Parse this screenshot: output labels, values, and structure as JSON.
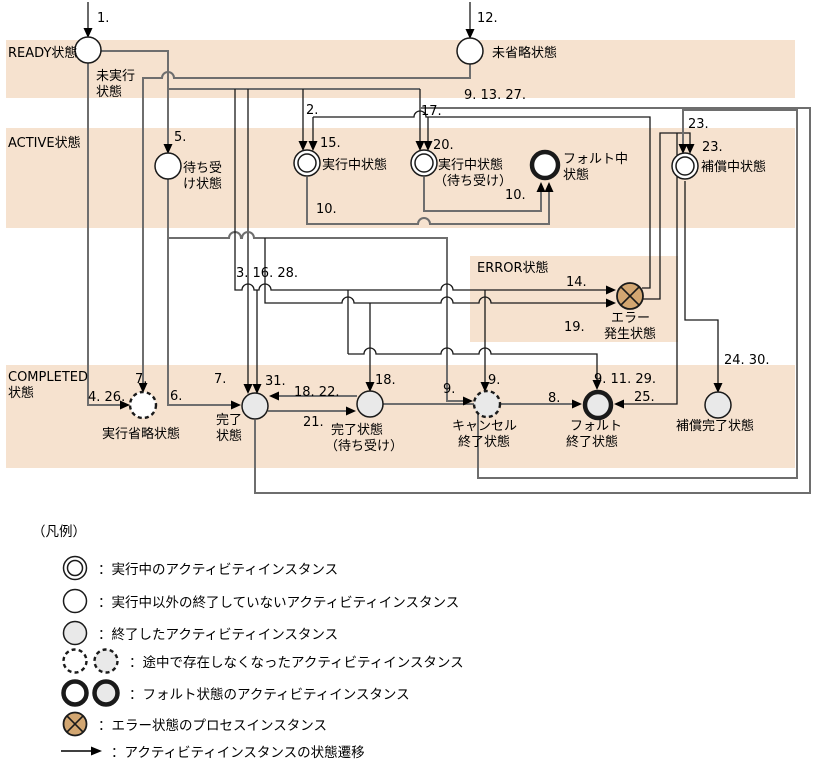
{
  "meta": {
    "width": 814,
    "height": 765
  },
  "colors": {
    "band": "#f6e2cf",
    "line_gray": "#6e6e6e",
    "line_black": "#1a1a1a",
    "node_stroke": "#1a1a1a",
    "gray_fill": "#e9e9e9",
    "white_fill": "#ffffff",
    "error_fill": "#d2a671",
    "arrow": "#000000",
    "text": "#000000"
  },
  "bands": [
    {
      "name": "band-ready",
      "x": 6,
      "y": 40,
      "w": 789,
      "h": 58
    },
    {
      "name": "band-active",
      "x": 6,
      "y": 128,
      "w": 789,
      "h": 100
    },
    {
      "name": "band-error",
      "x": 470,
      "y": 256,
      "w": 208,
      "h": 86
    },
    {
      "name": "band-completed",
      "x": 6,
      "y": 365,
      "w": 789,
      "h": 103
    }
  ],
  "nodes": [
    {
      "id": "state-unexecuted",
      "type": "white",
      "cx": 88,
      "cy": 50
    },
    {
      "id": "state-unskipped",
      "type": "white",
      "cx": 470,
      "cy": 51
    },
    {
      "id": "state-waiting",
      "type": "white",
      "cx": 168,
      "cy": 166
    },
    {
      "id": "state-executing",
      "type": "double",
      "cx": 307,
      "cy": 163
    },
    {
      "id": "state-executing-waiting",
      "type": "double",
      "cx": 424,
      "cy": 163
    },
    {
      "id": "state-faulting",
      "type": "fault-white",
      "cx": 545,
      "cy": 165
    },
    {
      "id": "state-compensating",
      "type": "double",
      "cx": 685,
      "cy": 166
    },
    {
      "id": "state-error-occurred",
      "type": "error",
      "cx": 630,
      "cy": 296
    },
    {
      "id": "state-execution-skipped",
      "type": "dashed-white",
      "cx": 143,
      "cy": 405
    },
    {
      "id": "state-completed",
      "type": "gray",
      "cx": 255,
      "cy": 406
    },
    {
      "id": "state-completed-waiting",
      "type": "gray",
      "cx": 370,
      "cy": 404
    },
    {
      "id": "state-cancel-ended",
      "type": "dashed-gray",
      "cx": 487,
      "cy": 404
    },
    {
      "id": "state-fault-ended",
      "type": "fault-gray",
      "cx": 598,
      "cy": 405
    },
    {
      "id": "state-compensation-completed",
      "type": "gray",
      "cx": 718,
      "cy": 405
    }
  ],
  "texts": [
    {
      "t": "READY状態",
      "x": 8,
      "y": 57,
      "cls": "band"
    },
    {
      "t": "ACTIVE状態",
      "x": 8,
      "y": 147,
      "cls": "band"
    },
    {
      "t": "ERROR状態",
      "x": 477,
      "y": 272,
      "cls": "band"
    },
    {
      "t": "COMPLETED",
      "x": 8,
      "y": 381,
      "cls": "band"
    },
    {
      "t": "状態",
      "x": 8,
      "y": 397,
      "cls": "band"
    },
    {
      "t": "未実行",
      "x": 96,
      "y": 80,
      "cls": "lbl"
    },
    {
      "t": "状態",
      "x": 96,
      "y": 96,
      "cls": "lbl"
    },
    {
      "t": "未省略状態",
      "x": 492,
      "y": 57,
      "cls": "lbl"
    },
    {
      "t": "待ち受",
      "x": 183,
      "y": 172,
      "cls": "lbl"
    },
    {
      "t": "け状態",
      "x": 183,
      "y": 188,
      "cls": "lbl"
    },
    {
      "t": "実行中状態",
      "x": 322,
      "y": 169,
      "cls": "lbl"
    },
    {
      "t": "実行中状態",
      "x": 438,
      "y": 169,
      "cls": "lbl"
    },
    {
      "t": "（待ち受け）",
      "x": 434,
      "y": 185,
      "cls": "lbl"
    },
    {
      "t": "フォルト中",
      "x": 563,
      "y": 163,
      "cls": "lbl"
    },
    {
      "t": "状態",
      "x": 563,
      "y": 179,
      "cls": "lbl"
    },
    {
      "t": "補償中状態",
      "x": 701,
      "y": 171,
      "cls": "lbl"
    },
    {
      "t": "エラー",
      "x": 611,
      "y": 322,
      "cls": "lbl"
    },
    {
      "t": "発生状態",
      "x": 604,
      "y": 338,
      "cls": "lbl"
    },
    {
      "t": "実行省略状態",
      "x": 102,
      "y": 438,
      "cls": "lbl"
    },
    {
      "t": "完了",
      "x": 216,
      "y": 424,
      "cls": "lbl"
    },
    {
      "t": "状態",
      "x": 216,
      "y": 440,
      "cls": "lbl"
    },
    {
      "t": "完了状態",
      "x": 331,
      "y": 434,
      "cls": "lbl"
    },
    {
      "t": "（待ち受け）",
      "x": 325,
      "y": 450,
      "cls": "lbl"
    },
    {
      "t": "キャンセル",
      "x": 452,
      "y": 430,
      "cls": "lbl"
    },
    {
      "t": "終了状態",
      "x": 458,
      "y": 446,
      "cls": "lbl"
    },
    {
      "t": "フォルト",
      "x": 570,
      "y": 430,
      "cls": "lbl"
    },
    {
      "t": "終了状態",
      "x": 566,
      "y": 446,
      "cls": "lbl"
    },
    {
      "t": "補償完了状態",
      "x": 676,
      "y": 430,
      "cls": "lbl"
    },
    {
      "t": "1.",
      "x": 97,
      "y": 22,
      "cls": "num"
    },
    {
      "t": "12.",
      "x": 477,
      "y": 22,
      "cls": "num"
    },
    {
      "t": "9. 13. 27.",
      "x": 464,
      "y": 99,
      "cls": "num"
    },
    {
      "t": "17.",
      "x": 421,
      "y": 115,
      "cls": "num"
    },
    {
      "t": "2.",
      "x": 306,
      "y": 114,
      "cls": "num"
    },
    {
      "t": "5.",
      "x": 174,
      "y": 141,
      "cls": "num"
    },
    {
      "t": "15.",
      "x": 320,
      "y": 147,
      "cls": "num"
    },
    {
      "t": "20.",
      "x": 433,
      "y": 149,
      "cls": "num"
    },
    {
      "t": "23.",
      "x": 688,
      "y": 128,
      "cls": "num"
    },
    {
      "t": "23.",
      "x": 702,
      "y": 151,
      "cls": "num"
    },
    {
      "t": "10.",
      "x": 505,
      "y": 199,
      "cls": "num"
    },
    {
      "t": "10.",
      "x": 316,
      "y": 213,
      "cls": "num"
    },
    {
      "t": "3. 16. 28.",
      "x": 236,
      "y": 277,
      "cls": "num"
    },
    {
      "t": "14.",
      "x": 566,
      "y": 286,
      "cls": "num"
    },
    {
      "t": "19.",
      "x": 564,
      "y": 331,
      "cls": "num"
    },
    {
      "t": "24. 30.",
      "x": 724,
      "y": 364,
      "cls": "num"
    },
    {
      "t": "4. 26.",
      "x": 88,
      "y": 401,
      "cls": "num"
    },
    {
      "t": "7.",
      "x": 135,
      "y": 383,
      "cls": "num"
    },
    {
      "t": "6.",
      "x": 170,
      "y": 400,
      "cls": "num"
    },
    {
      "t": "7.",
      "x": 214,
      "y": 383,
      "cls": "num"
    },
    {
      "t": "31.",
      "x": 265,
      "y": 385,
      "cls": "num"
    },
    {
      "t": "18. 22.",
      "x": 294,
      "y": 396,
      "cls": "num"
    },
    {
      "t": "18.",
      "x": 375,
      "y": 384,
      "cls": "num"
    },
    {
      "t": "21.",
      "x": 303,
      "y": 426,
      "cls": "num"
    },
    {
      "t": "9.",
      "x": 443,
      "y": 393,
      "cls": "num"
    },
    {
      "t": "9.",
      "x": 488,
      "y": 384,
      "cls": "num"
    },
    {
      "t": "8.",
      "x": 548,
      "y": 402,
      "cls": "num"
    },
    {
      "t": "9. 11. 29.",
      "x": 594,
      "y": 383,
      "cls": "num"
    },
    {
      "t": "25.",
      "x": 634,
      "y": 401,
      "cls": "num"
    }
  ],
  "edges": [
    {
      "name": "edge-1-in",
      "d": "M88,2 L88,29",
      "c": "k"
    },
    {
      "name": "edge-12-in",
      "d": "M470,2 L470,30",
      "c": "k"
    },
    {
      "name": "edge-5-to-waiting",
      "d": "M101,51 L168,51 L168,145",
      "c": "g"
    },
    {
      "name": "edge-7-to-skipped",
      "d": "M470,64 L470,78 L174,78 A6,6 0 0 0 162,78 L143,78 L143,384",
      "c": "g"
    },
    {
      "name": "edge-bus-89",
      "d": "M169,89 L420,89",
      "c": "g"
    },
    {
      "name": "edge-2-to-executing",
      "d": "M303,89 L303,142",
      "c": "k"
    },
    {
      "name": "edge-17-to-exec-waiting",
      "d": "M420,89 L420,142",
      "c": "k"
    },
    {
      "name": "edge-7b-to-completed",
      "d": "M248,89 L248,385",
      "c": "k"
    },
    {
      "name": "edge-4-26",
      "d": "M88,63 L88,405 L121,405",
      "c": "g"
    },
    {
      "name": "edge-6",
      "d": "M168,179 L168,405 L232,405",
      "c": "g"
    },
    {
      "name": "edge-9-cancel-left",
      "d": "M168,238 L229,238 A6,6 0 0 1 241,238 L242,238 A6,6 0 0 1 254,238 L447,238 L447,401 L464,401",
      "c": "g"
    },
    {
      "name": "edge-14-bus",
      "d": "M235,89 L235,290 L242,290 A6,6 0 0 1 254,290 L259,290 A6,6 0 0 1 271,290 L441,290 A6,6 0 0 1 453,290 L607,290",
      "c": "k"
    },
    {
      "name": "edge-31",
      "d": "M257,290 L257,385",
      "c": "k"
    },
    {
      "name": "edge-9-cancel-top",
      "d": "M485,290 L485,383",
      "c": "k"
    },
    {
      "name": "edge-drop-348",
      "d": "M348,290 L348,354",
      "c": "k"
    },
    {
      "name": "edge-19-bus",
      "d": "M265,238 L265,303 L342,303 A6,6 0 0 1 354,303 L441,303 A6,6 0 0 1 453,303 L479,303 A6,6 0 0 1 491,303 L607,303",
      "c": "k"
    },
    {
      "name": "edge-18",
      "d": "M370,303 L370,383",
      "c": "k"
    },
    {
      "name": "edge-9-11-29-bus",
      "d": "M348,354 L364,354 A6,6 0 0 1 376,354 L441,354 A6,6 0 0 1 453,354 L479,354 A6,6 0 0 1 491,354 L597,354 L597,381",
      "c": "k"
    },
    {
      "name": "edge-10-left",
      "d": "M307,177 L307,224 L418,224 A6,6 0 0 1 430,224 L549,224 L549,191",
      "c": "g"
    },
    {
      "name": "edge-10-right",
      "d": "M424,177 L424,211 L541,211 L541,191",
      "c": "g"
    },
    {
      "name": "edge-error-retry-bus",
      "d": "M642,288 L650,288 L650,117 L426,117 A6,6 0 0 0 414,117 L313,117",
      "c": "k"
    },
    {
      "name": "edge-15",
      "d": "M313,117 L313,142",
      "c": "k"
    },
    {
      "name": "edge-20",
      "d": "M428,117 L428,142",
      "c": "k"
    },
    {
      "name": "edge-23-inner",
      "d": "M642,299 L660,299 L660,133 L690,133 L690,145",
      "c": "k"
    },
    {
      "name": "edge-25",
      "d": "M677,133 L677,404 L623,404",
      "c": "k"
    },
    {
      "name": "edge-24-30",
      "d": "M685,181 L685,320 L718,320 L718,384",
      "c": "k"
    },
    {
      "name": "edge-loop-completed",
      "d": "M255,420 L255,493 L810,493 L810,108 L421,108",
      "c": "g"
    },
    {
      "name": "edge-23-outer-loop",
      "d": "M383,404 L478,404 L478,478 L797,478 L797,110 L683,110 L683,145",
      "c": "g"
    },
    {
      "name": "edge-18-22",
      "d": "M357,396 L278,396",
      "c": "g"
    },
    {
      "name": "edge-21",
      "d": "M268,411 L347,411",
      "c": "g"
    },
    {
      "name": "edge-8",
      "d": "M500,404 L573,404",
      "c": "g"
    }
  ],
  "arrows": [
    {
      "x": 88,
      "y": 38,
      "dir": "d"
    },
    {
      "x": 470,
      "y": 39,
      "dir": "d"
    },
    {
      "x": 168,
      "y": 154,
      "dir": "d"
    },
    {
      "x": 143,
      "y": 393,
      "dir": "d"
    },
    {
      "x": 303,
      "y": 151,
      "dir": "d"
    },
    {
      "x": 313,
      "y": 151,
      "dir": "d"
    },
    {
      "x": 420,
      "y": 151,
      "dir": "d"
    },
    {
      "x": 428,
      "y": 151,
      "dir": "d"
    },
    {
      "x": 549,
      "y": 182,
      "dir": "u"
    },
    {
      "x": 541,
      "y": 182,
      "dir": "u"
    },
    {
      "x": 683,
      "y": 154,
      "dir": "d"
    },
    {
      "x": 690,
      "y": 154,
      "dir": "d"
    },
    {
      "x": 616,
      "y": 290,
      "dir": "r"
    },
    {
      "x": 616,
      "y": 303,
      "dir": "r"
    },
    {
      "x": 248,
      "y": 394,
      "dir": "d"
    },
    {
      "x": 257,
      "y": 394,
      "dir": "d"
    },
    {
      "x": 130,
      "y": 405,
      "dir": "r"
    },
    {
      "x": 241,
      "y": 405,
      "dir": "r"
    },
    {
      "x": 269,
      "y": 396,
      "dir": "l"
    },
    {
      "x": 356,
      "y": 411,
      "dir": "r"
    },
    {
      "x": 370,
      "y": 392,
      "dir": "d"
    },
    {
      "x": 473,
      "y": 401,
      "dir": "r"
    },
    {
      "x": 485,
      "y": 392,
      "dir": "d"
    },
    {
      "x": 582,
      "y": 404,
      "dir": "r"
    },
    {
      "x": 614,
      "y": 404,
      "dir": "l"
    },
    {
      "x": 597,
      "y": 390,
      "dir": "d"
    },
    {
      "x": 718,
      "y": 393,
      "dir": "d"
    }
  ],
  "legend": {
    "header": "（凡例）",
    "rows": [
      {
        "icons": [
          "double"
        ],
        "text": "：実行中のアクティビティインスタンス",
        "top": 553
      },
      {
        "icons": [
          "white"
        ],
        "text": "：実行中以外の終了していないアクティビティインスタンス",
        "top": 586
      },
      {
        "icons": [
          "gray"
        ],
        "text": "：終了したアクティビティインスタンス",
        "top": 618
      },
      {
        "icons": [
          "dashed-white",
          "dashed-gray"
        ],
        "text": "：途中で存在しなくなったアクティビティインスタンス",
        "top": 646
      },
      {
        "icons": [
          "fault-white",
          "fault-gray"
        ],
        "text": "：フォルト状態のアクティビティインスタンス",
        "top": 678
      },
      {
        "icons": [
          "error"
        ],
        "text": "：エラー状態のプロセスインスタンス",
        "top": 709
      },
      {
        "icons": [
          "arrow"
        ],
        "text": "：アクティビティインスタンスの状態遷移",
        "top": 736
      }
    ]
  }
}
